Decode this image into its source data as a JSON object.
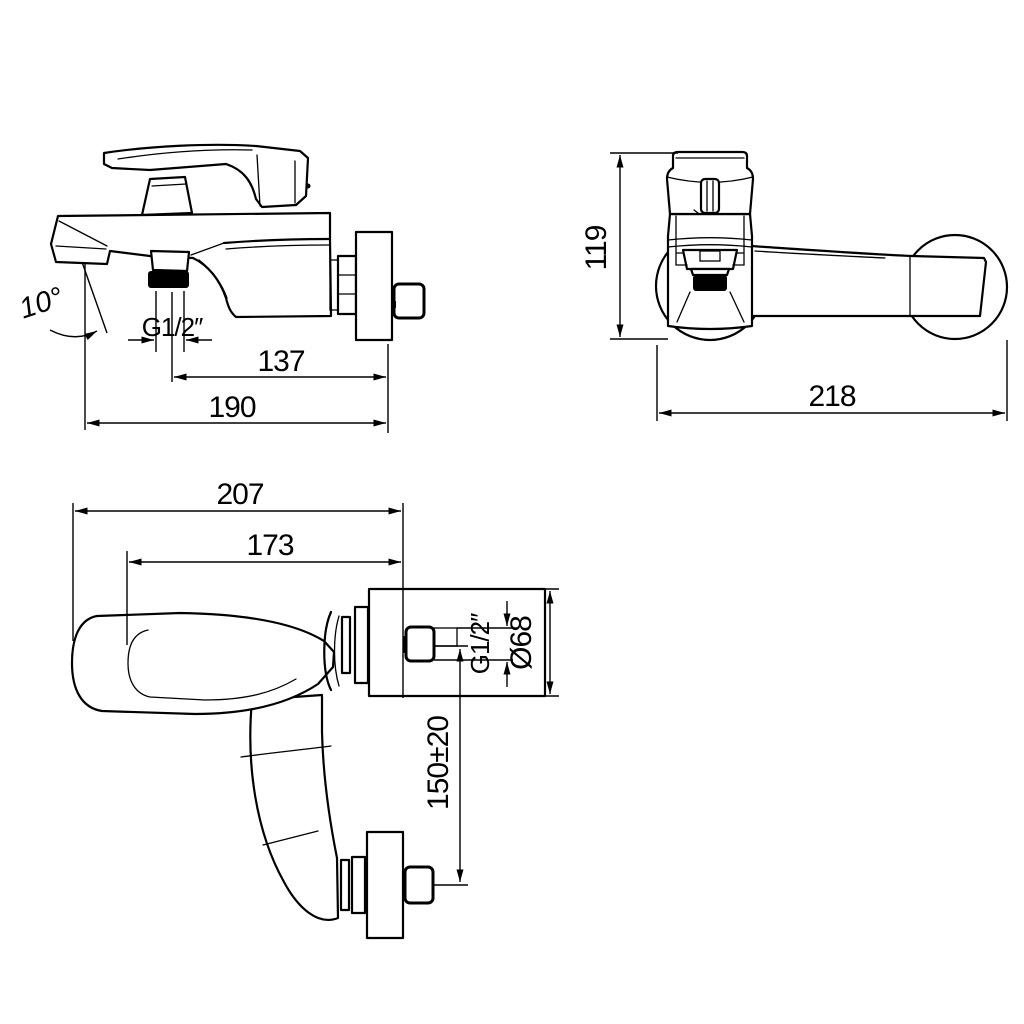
{
  "drawing": {
    "background_color": "#ffffff",
    "line_color": "#000000",
    "views": {
      "side": {
        "dims": {
          "spout_angle": "10°",
          "outlet_thread": "G1/2″",
          "outlet_to_wall": "137",
          "overall_projection": "190"
        }
      },
      "front": {
        "dims": {
          "body_height": "119",
          "overall_width": "218"
        }
      },
      "plan": {
        "dims": {
          "overall_projection": "207",
          "handle_projection": "173",
          "inlet_thread": "G1/2″",
          "escutcheon_diameter": "Ø68",
          "inlet_centers": "150±20"
        }
      }
    }
  }
}
